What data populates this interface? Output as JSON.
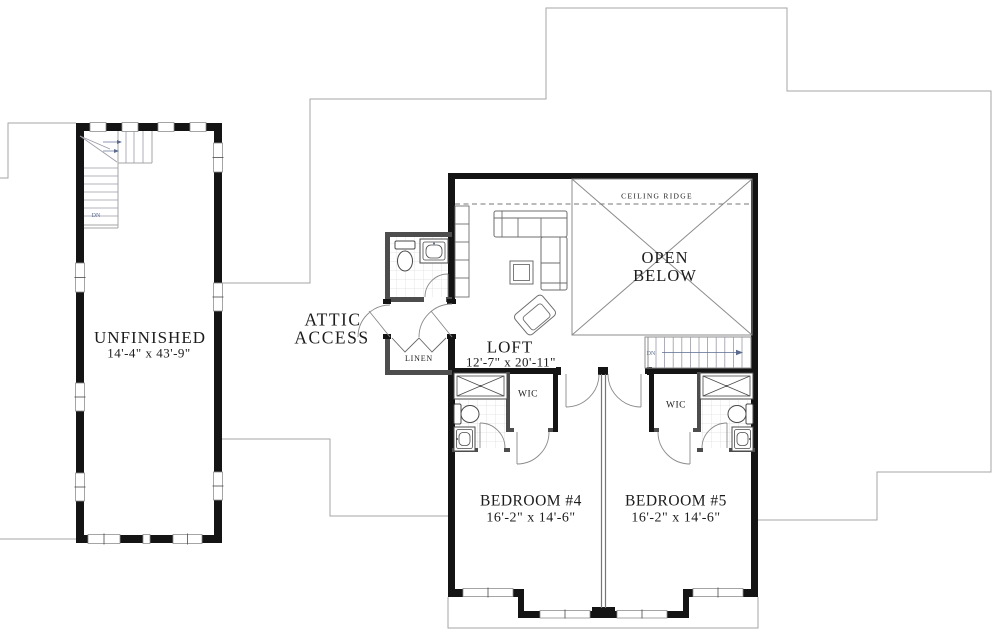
{
  "labels": {
    "unfinished_name": "UNFINISHED",
    "unfinished_dims": "14'-4\" x 43'-9\"",
    "attic_line1": "ATTIC",
    "attic_line2": "ACCESS",
    "loft_name": "LOFT",
    "loft_dims": "12'-7\" x 20'-11\"",
    "open_below_line1": "OPEN",
    "open_below_line2": "BELOW",
    "ceiling_ridge": "CEILING RIDGE",
    "bedroom4_name": "BEDROOM #4",
    "bedroom4_dims": "16'-2\" x 14'-6\"",
    "bedroom5_name": "BEDROOM #5",
    "bedroom5_dims": "16'-2\" x 14'-6\"",
    "wic_left": "WIC",
    "wic_right": "WIC",
    "linen": "LINEN",
    "dn_unfinished": "DN",
    "dn_main": "DN"
  },
  "colors": {
    "wall": "#141414",
    "interior_wall": "#4d4d4d",
    "roof_outline": "#a6a6a6",
    "stair_annotation": "#5a6b8f",
    "background": "#ffffff"
  }
}
